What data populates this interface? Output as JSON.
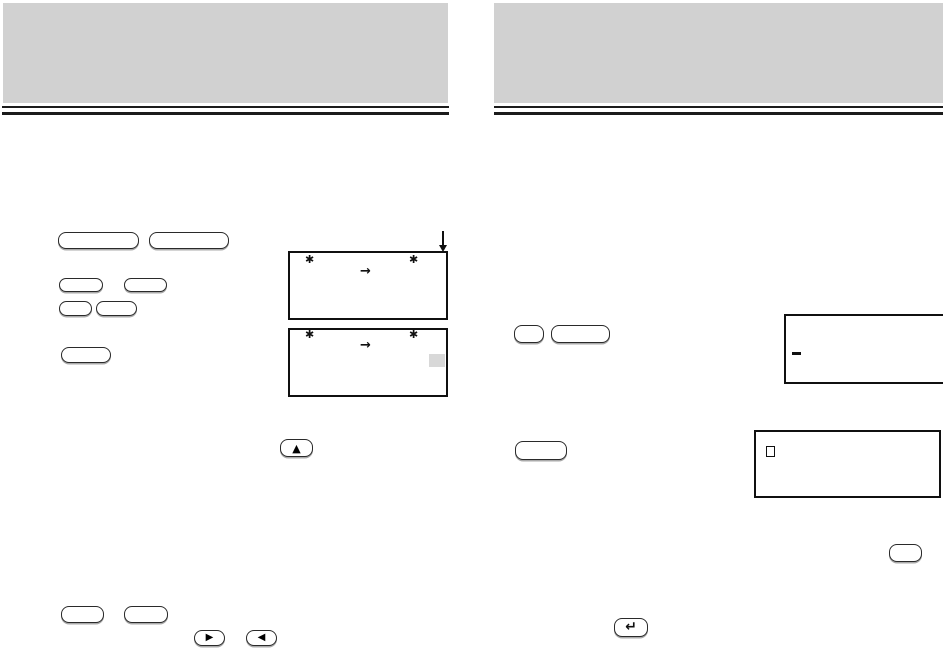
{
  "colors": {
    "paper": "#ffffff",
    "banner": "#d1d1d1",
    "rule": "#1b1b1b",
    "key_border": "#2a2a2a",
    "key_shadow": "#aaaaaa",
    "display_border": "#101010",
    "ink": "#101010",
    "highlight_square": "#d8d8d8"
  },
  "glyphs": {
    "asterisk": "✱",
    "right_arrow": "→",
    "up_triangle": "▲",
    "right_triangle": "▶",
    "left_triangle": "◀",
    "enter_arrow": "↵"
  },
  "left_page": {
    "header_banner_text": "",
    "display_top": {
      "left_star": "✱",
      "arrow": "→",
      "right_star": "✱"
    },
    "display_bottom": {
      "left_star": "✱",
      "arrow": "→",
      "right_star": "✱"
    }
  },
  "right_page": {
    "header_banner_text": "",
    "display_top_cursor": "dash",
    "display_bottom_cursor": "open-square"
  }
}
